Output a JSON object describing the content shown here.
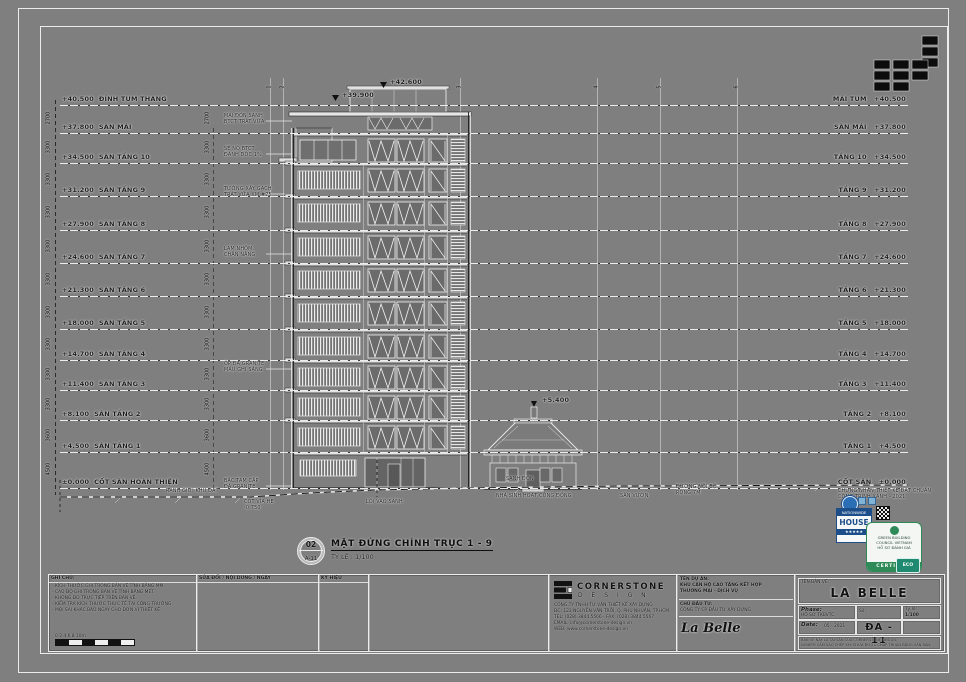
{
  "levels": [
    {
      "left": "+40.500  ĐỈNH TUM THANG",
      "right": "MÁI TUM   +40.500",
      "dim": "2700"
    },
    {
      "left": "+37.800  SÀN MÁI",
      "right": "SÀN MÁI   +37.800",
      "dim": "3300"
    },
    {
      "left": "+34.500  SÀN TẦNG 10",
      "right": "TẦNG 10   +34.500",
      "dim": "3300"
    },
    {
      "left": "+31.200  SÀN TẦNG 9",
      "right": "TẦNG 9   +31.200",
      "dim": "3300"
    },
    {
      "left": "+27.900  SÀN TẦNG 8",
      "right": "TẦNG 8   +27.900",
      "dim": "3300"
    },
    {
      "left": "+24.600  SÀN TẦNG 7",
      "right": "TẦNG 7   +24.600",
      "dim": "3300"
    },
    {
      "left": "+21.300  SÀN TẦNG 6",
      "right": "TẦNG 6   +21.300",
      "dim": "3300"
    },
    {
      "left": "+18.000  SÀN TẦNG 5",
      "right": "TẦNG 5   +18.000",
      "dim": "3300"
    },
    {
      "left": "+14.700  SÀN TẦNG 4",
      "right": "TẦNG 4   +14.700",
      "dim": "3300"
    },
    {
      "left": "+11.400  SÀN TẦNG 3",
      "right": "TẦNG 3   +11.400",
      "dim": "3300"
    },
    {
      "left": "+8.100  SÀN TẦNG 2",
      "right": "TẦNG 2   +8.100",
      "dim": "3600"
    },
    {
      "left": "+4.500  SÀN TẦNG 1",
      "right": "TẦNG 1   +4.500",
      "dim": "4500"
    },
    {
      "left": "±0.000  CỐT SÂN HOÀN THIỆN",
      "right": "CỐT SÂN   ±0.000",
      "dim": ""
    }
  ],
  "grid_axes": [
    "1",
    "2",
    "3",
    "4",
    "5",
    "6"
  ],
  "annotations": [
    "MÁI ĐÓN SẢNH\nBTCT TRÁT VỮA",
    "SÊ NÔ BTCT\nĐÁNH DỐC 1%",
    "TƯỜNG XÂY GẠCH\nTRÁT VỮA XM #75",
    "LAM NHÔM\nCHẮN NẮNG",
    "ỐP ĐÁ GRANITE\nMÀU GHI SÁNG",
    "BẬC TAM CẤP\nĐÁ GRANITE"
  ],
  "markers": [
    "+42.600",
    "+39.900",
    "+5.400"
  ],
  "ground_labels": [
    "RANH GIỚI KHU ĐẤT",
    "CỐT VỈA HÈ\n-0.750",
    "LỐI VÀO SẢNH",
    "SẢNH ĐÓN",
    "SÂN VƯỜN",
    "ĐƯỜNG NỘI BỘ\nRỘNG 7M"
  ],
  "pavilion_label": "NHÀ SINH HOẠT CỘNG ĐỒNG",
  "drawing_title": {
    "bubble_top": "02",
    "bubble_bottom": "A-11",
    "line1": "MẶT ĐỨNG CHÍNH TRỤC 1 - 9",
    "line2": "TỶ LỆ : 1/100"
  },
  "stamps": {
    "note_lines": "CHỨNG NHẬN THIẾT KẾ ĐẠT CHUẨN\nCÔNG TRÌNH XANH - 2021",
    "house_top": "NATIONWIDE",
    "house_mid": "HOUSE",
    "house_bottom": "★★★★★",
    "green_lines": "GREEN BUILDING\nCOUNCIL VIETNAM\nHỒ SƠ ĐÁNH GIÁ",
    "green_footer": "CERTIFIED",
    "teal_badge": "ECO"
  },
  "titleblock": {
    "notes": {
      "header": "GHI CHÚ:",
      "lines": "- KÍCH THƯỚC GHI TRONG BẢN VẼ TÍNH BẰNG MM.\n- CAO ĐỘ GHI TRONG BẢN VẼ TÍNH BẰNG MÉT.\n- KHÔNG ĐO TRỰC TIẾP TRÊN BẢN VẼ.\n- KIỂM TRA KÍCH THƯỚC THỰC TẾ TẠI CÔNG TRƯỜNG.\n- MỌI SAI KHÁC BÁO NGAY CHO ĐƠN VỊ THIẾT KẾ.",
      "scale_ticks": "0    2    4    6    8    10m"
    },
    "revisions_header": "SỬA ĐỔI / NỘI DUNG / NGÀY",
    "legend_header": "KÝ HIỆU",
    "firm": {
      "name": "CORNERSTONE",
      "sub": "D E S I G N",
      "lines": "CÔNG TY TNHH TƯ VẤN THIẾT KẾ XÂY DỰNG\nĐC: 123 NGUYỄN VĂN TRỖI, Q. PHÚ NHUẬN, TP.HCM\nTEL: (028) 3844 5566  -  FAX: (028) 3844 5567\nEMAIL: info@cornerstone-design.vn\nWEB: www.cornerstone-design.vn"
    },
    "project": {
      "label": "TÊN DỰ ÁN:",
      "name": "KHU CĂN HỘ CAO TẦNG KẾT HỢP\nTHƯƠNG MẠI - DỊCH VỤ",
      "owner_label": "CHỦ ĐẦU TƯ:",
      "owner": "CÔNG TY CP ĐẦU TƯ XÂY DỰNG",
      "big": "La Belle"
    },
    "sheet": {
      "name_label": "TÊN BẢN VẼ:",
      "big_title": "LA BELLE",
      "phase_label": "Phase:",
      "phase": "HỒ SƠ TKBVTC",
      "date_label": "Date:",
      "date": "05 - 2021",
      "no_label": "Số:",
      "number": "ĐA - 11",
      "scale_label": "Tỷ lệ:",
      "scale": "1/100",
      "fine_print": "BẢN VẼ NÀY LÀ TÀI SẢN CỦA CORNERSTONE DESIGN.\nNGHIÊM CẤM SAO CHÉP KHI CHƯA ĐƯỢC CHẤP THUẬN BẰNG VĂN BẢN."
    }
  }
}
